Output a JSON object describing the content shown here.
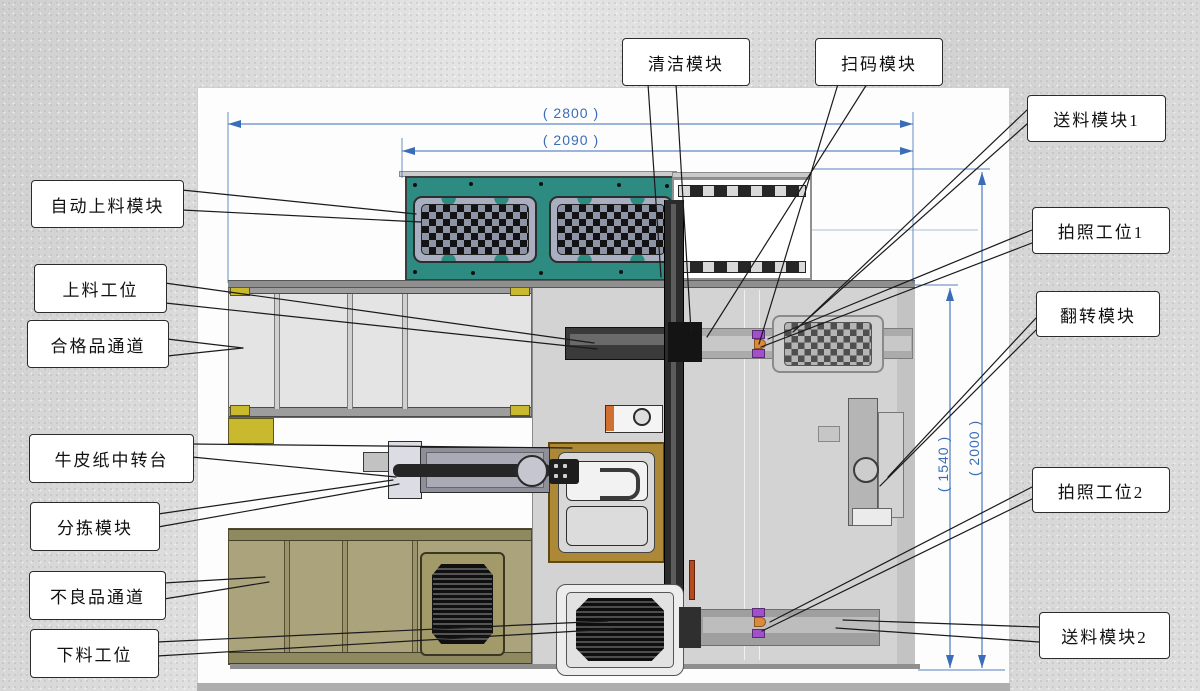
{
  "diagram": {
    "type": "machine-layout-top-view",
    "labels": {
      "auto_loading_module": "自动上料模块",
      "loading_station": "上料工位",
      "qualified_channel": "合格品通道",
      "kraft_paper_station": "牛皮纸中转台",
      "sorting_module": "分拣模块",
      "defective_channel": "不良品通道",
      "unloading_station": "下料工位",
      "cleaning_module": "清洁模块",
      "scanning_module": "扫码模块",
      "feeding_module_1": "送料模块1",
      "photo_station_1": "拍照工位1",
      "flipping_module": "翻转模块",
      "photo_station_2": "拍照工位2",
      "feeding_module_2": "送料模块2"
    },
    "dimensions": {
      "width_overall": "( 2800 )",
      "width_inner": "( 2090 )",
      "height_inner": "( 1540 )",
      "height_overall": "( 2000 )"
    },
    "colors": {
      "dimension_blue": "#3a6cb8",
      "teal_panel": "#2e8b81",
      "olive_conveyor": "#aaa37b",
      "golden_platform": "#ad8937",
      "marker_purple": "#a050c8",
      "marker_orange": "#d98a3d",
      "leader_line": "#1a1a1a"
    }
  }
}
